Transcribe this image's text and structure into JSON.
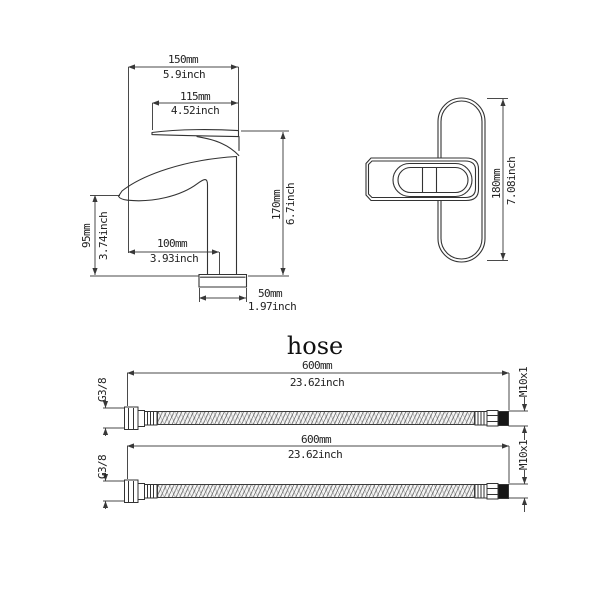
{
  "page": {
    "background": "#ffffff",
    "line_color": "#383838"
  },
  "faucet_front": {
    "top_width_mm": "150mm",
    "top_width_inch": "5.9inch",
    "spout_width_mm": "115mm",
    "spout_width_inch": "4.52inch",
    "spout_height_mm": "95mm",
    "spout_height_inch": "3.74inch",
    "total_height_mm": "170mm",
    "total_height_inch": "6.7inch",
    "spout_reach_mm": "100mm",
    "spout_reach_inch": "3.93inch",
    "base_width_mm": "50mm",
    "base_width_inch": "1.97inch"
  },
  "faucet_side": {
    "height_mm": "180mm",
    "height_inch": "7.08inch"
  },
  "hose_section": {
    "title": "hose",
    "hoses": [
      {
        "length_mm": "600mm",
        "length_inch": "23.62inch",
        "left_thread": "G3/8",
        "right_thread": "M10x1"
      },
      {
        "length_mm": "600mm",
        "length_inch": "23.62inch",
        "left_thread": "G3/8",
        "right_thread": "M10x1"
      }
    ]
  }
}
